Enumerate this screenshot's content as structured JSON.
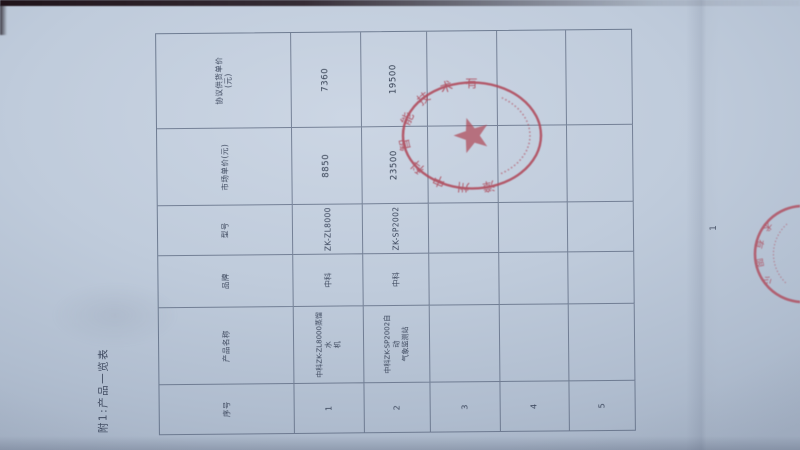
{
  "document": {
    "caption": "附1:产品一览表",
    "page_number": "1",
    "table": {
      "headers": [
        "序号",
        "产品名称",
        "品牌",
        "型号",
        "市场单价(元)",
        "协议供货单价\n(元)"
      ],
      "rows": [
        [
          "1",
          "中科ZK-ZL8000蒸馏水\n机",
          "中科",
          "ZK-ZL8000",
          "8850",
          "7360"
        ],
        [
          "2",
          "中科ZK-SP2002自动\n气象监测站",
          "中科",
          "ZK-SP2002",
          "23500",
          "19500"
        ],
        [
          "3",
          "",
          "",
          "",
          "",
          ""
        ],
        [
          "4",
          "",
          "",
          "",
          "",
          ""
        ],
        [
          "5",
          "",
          "",
          "",
          "",
          ""
        ]
      ]
    },
    "seal": {
      "company_arc_text": "漳州中科智能技术有限公司",
      "star_icon": "red-star",
      "edge_seal_arc_text": "术有限公司"
    }
  },
  "colors": {
    "paper": "#bfcbdb",
    "grid_line": "#526078",
    "ink": "#39445a",
    "seal_red": "#b0495a",
    "background_dark": "#11151f"
  },
  "layout_note": {
    "orientation_hint": "document rotated 90° counter-clockwise in photo"
  }
}
